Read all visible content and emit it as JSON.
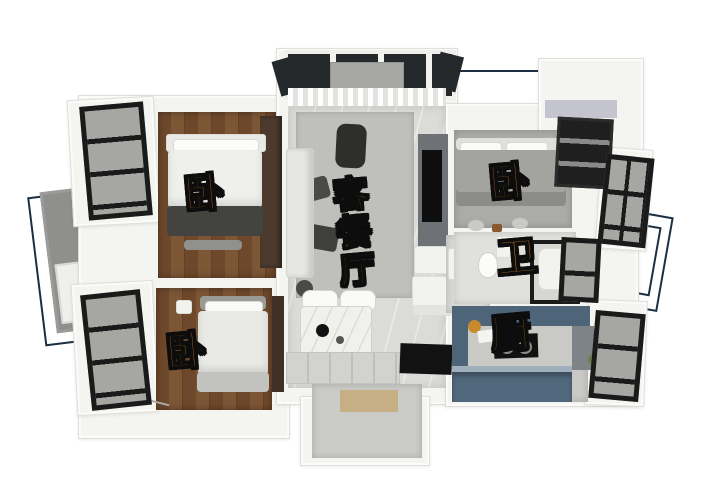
{
  "image": {
    "kind": "3d-rendered-floor-plan",
    "background": "#ffffff"
  },
  "palette": {
    "label_fill": "#F7941D",
    "label_stroke": "#0D0D0D",
    "plan_outline": "#1C2F42",
    "wall": "#F4F4F1",
    "wood_floor": "#6E482B",
    "living_floor": "#DBDBD7",
    "rug": "#BFBFBB",
    "kitchen_cabinet_blue": "#4E6579",
    "window_frame": "#1A1A1A",
    "window_glass": "#A6A6A3"
  },
  "rooms": [
    {
      "id": "bedroom-top-left",
      "label": "卧"
    },
    {
      "id": "bedroom-bottom-left",
      "label": "卧"
    },
    {
      "id": "living-dining",
      "label": "客餐厅"
    },
    {
      "id": "bedroom-right",
      "label": "卧"
    },
    {
      "id": "bathroom",
      "label": "卫"
    },
    {
      "id": "kitchen",
      "label": "厨"
    }
  ]
}
